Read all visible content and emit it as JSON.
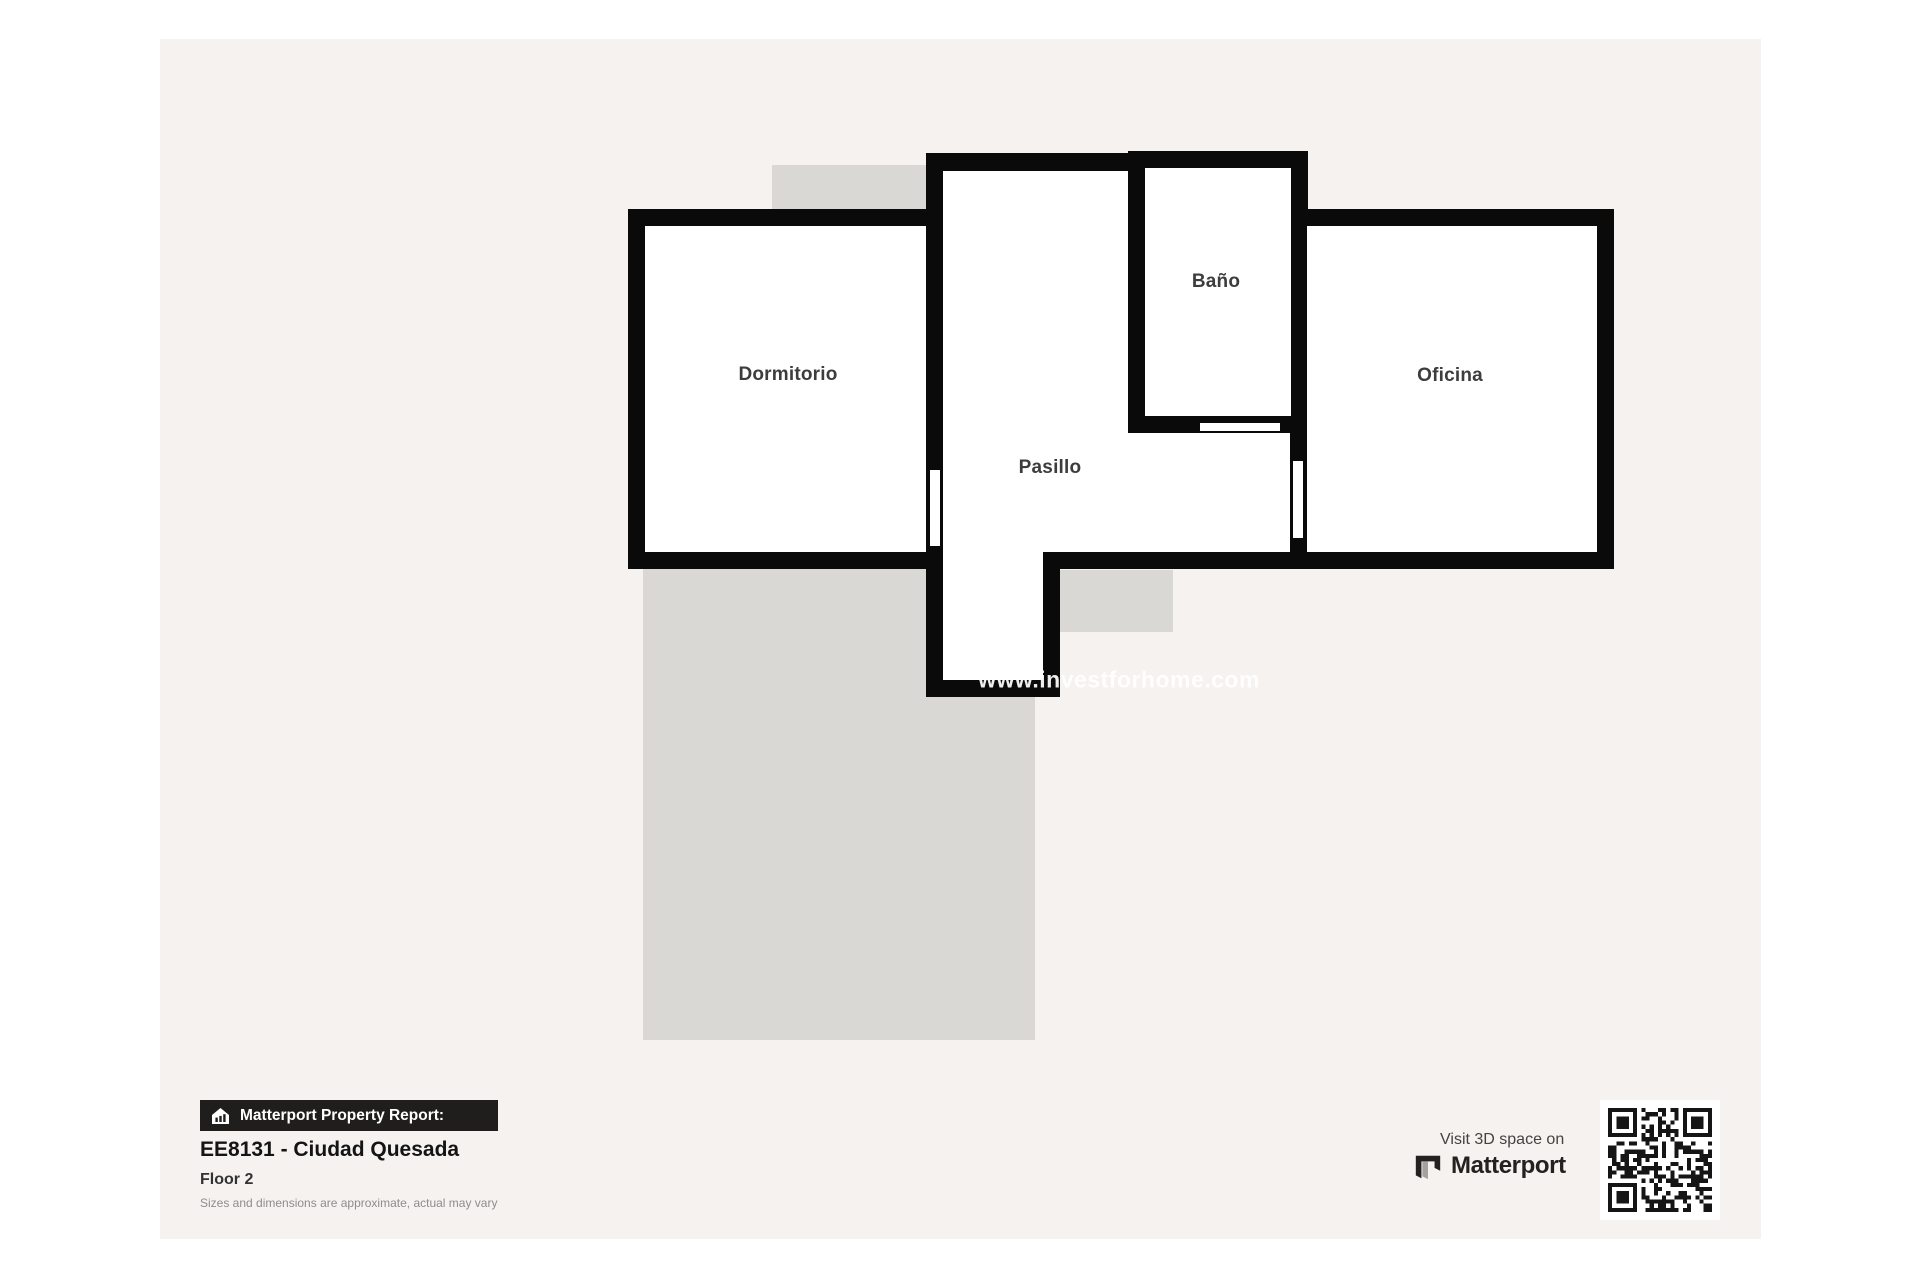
{
  "colors": {
    "page_bg": "#ffffff",
    "canvas_bg": "#f5f2ef",
    "wall": "#0a0a0a",
    "room_fill": "#ffffff",
    "underlay": "#d9d8d5",
    "room_label": "#3d3d3d",
    "badge_bg": "#201e1d",
    "badge_text": "#ffffff",
    "watermark_text_color": "#ffffff"
  },
  "floorplan": {
    "rooms": [
      {
        "label": "Dormitorio"
      },
      {
        "label": "Pasillo"
      },
      {
        "label": "Baño"
      },
      {
        "label": "Oficina"
      }
    ],
    "watermark": {
      "text": "www.investforhome.com"
    }
  },
  "footer": {
    "badge": {
      "icon": "house-chart-icon",
      "label": "Matterport Property Report:"
    },
    "title": "EE8131 - Ciudad Quesada",
    "floor_label": "Floor 2",
    "disclaimer": "Sizes and dimensions are approximate, actual may vary",
    "visit_3d": {
      "prefix": "Visit 3D space on",
      "brand": "Matterport",
      "logo_icon": "matterport-logo-icon",
      "qr_icon": "qr-code"
    }
  }
}
